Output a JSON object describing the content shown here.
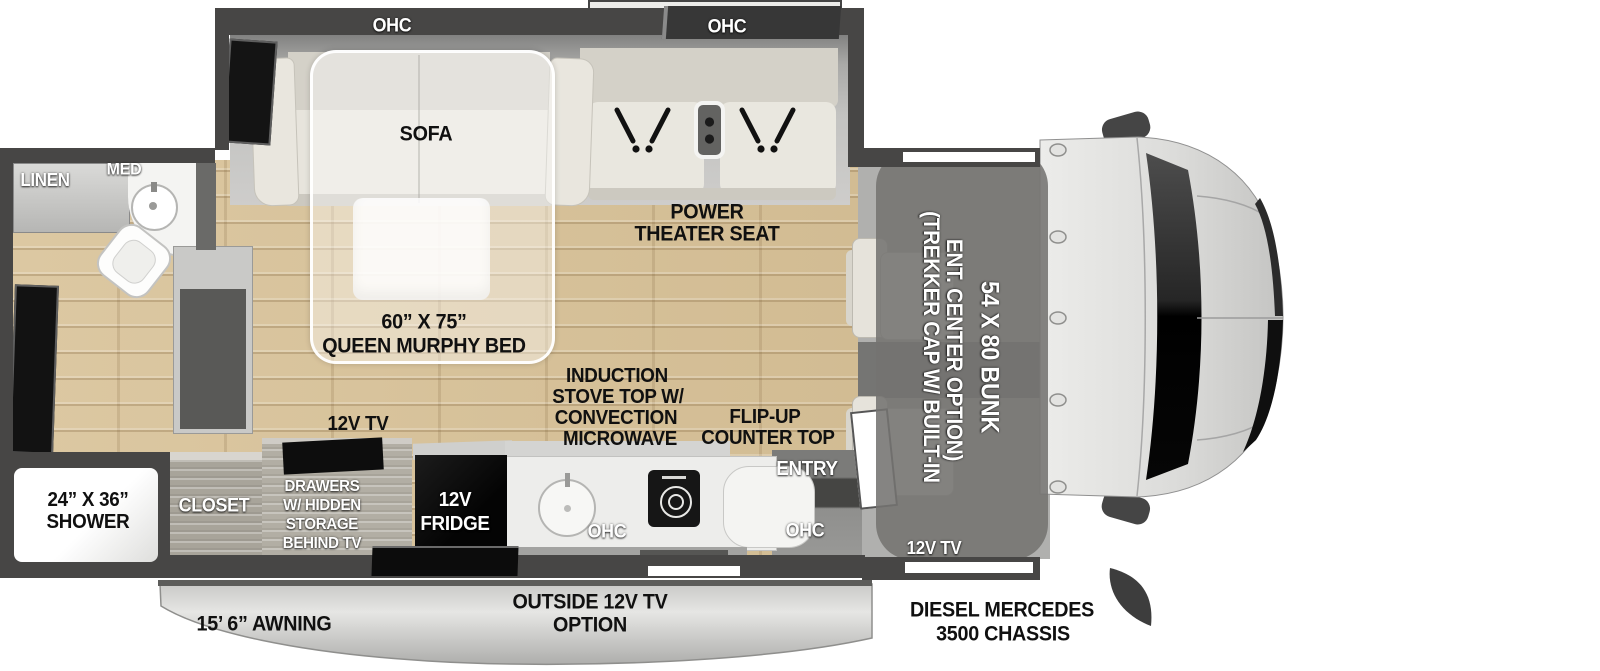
{
  "slideout": {
    "ohc_sofa": "OHC",
    "ohc_theater": "OHC",
    "sofa": "SOFA",
    "theater_line1": "POWER",
    "theater_line2": "THEATER SEAT"
  },
  "murphy": {
    "line1": "60” X 75”",
    "line2": "QUEEN MURPHY BED"
  },
  "bathroom": {
    "linen": "LINEN",
    "med": "MED",
    "shower_line1": "24” X 36”",
    "shower_line2": "SHOWER"
  },
  "kitchen": {
    "closet": "CLOSET",
    "drawers_line1": "DRAWERS",
    "drawers_line2": "W/ HIDDEN",
    "drawers_line3": "STORAGE",
    "drawers_line4": "BEHIND TV",
    "tv": "12V TV",
    "fridge_line1": "12V",
    "fridge_line2": "FRIDGE",
    "induction_line1": "INDUCTION",
    "induction_line2": "STOVE TOP W/",
    "induction_line3": "CONVECTION",
    "induction_line4": "MICROWAVE",
    "flipup_line1": "FLIP-UP",
    "flipup_line2": "COUNTER TOP",
    "ohc_left": "OHC",
    "ohc_right": "OHC",
    "entry": "ENTRY"
  },
  "cab": {
    "bunk_size": "54 X 80 BUNK",
    "cap_note_line1": "(TREKKER CAP W/ BUILT-IN",
    "cap_note_line2": "ENT. CENTER OPTION)",
    "tv": "12V TV",
    "chassis_line1": "DIESEL MERCEDES",
    "chassis_line2": "3500 CHASSIS"
  },
  "exterior": {
    "awning": "15’ 6” AWNING",
    "outside_tv_line1": "OUTSIDE 12V TV",
    "outside_tv_line2": "OPTION"
  },
  "colors": {
    "wall": "#474645",
    "wood_floor": "#d7c096",
    "cab_body_light": "#e2e2e2",
    "bunk_overlay": "rgba(116,115,113,0.88)",
    "murphy_overlay": "rgba(255,255,255,0.38)",
    "label_black": "#101010",
    "label_white": "#ffffff"
  }
}
